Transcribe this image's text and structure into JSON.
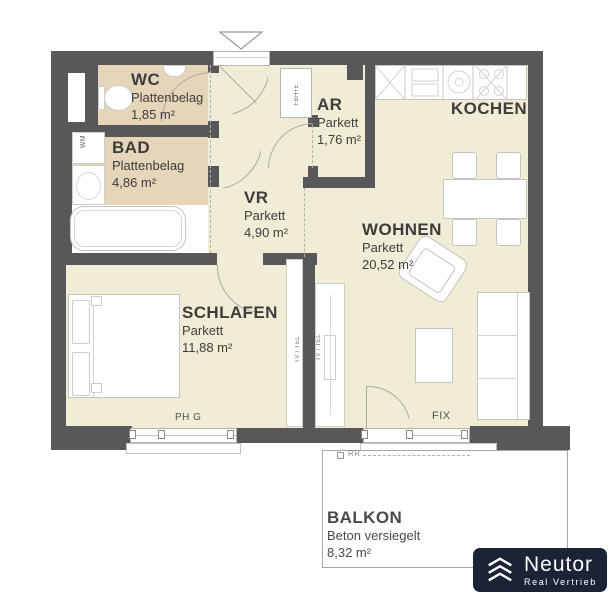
{
  "plan": {
    "rooms": {
      "wc": {
        "name": "WC",
        "floor": "Plattenbelag",
        "area": "1,85 m²"
      },
      "bad": {
        "name": "BAD",
        "floor": "Plattenbelag",
        "area": "4,86 m²"
      },
      "ar": {
        "name": "AR",
        "floor": "Parkett",
        "area": "1,76 m²"
      },
      "vr": {
        "name": "VR",
        "floor": "Parkett",
        "area": "4,90 m²"
      },
      "kochen": {
        "name": "KOCHEN"
      },
      "wohnen": {
        "name": "WOHNEN",
        "floor": "Parkett",
        "area": "20,52 m²"
      },
      "schlafen": {
        "name": "SCHLAFEN",
        "floor": "Parkett",
        "area": "11,88 m²"
      },
      "balkon": {
        "name": "BALKON",
        "floor": "Beton versiegelt",
        "area": "8,32 m²"
      }
    },
    "annotations": {
      "wm": "WM",
      "fbhe": "FBH+E",
      "tv_tel": "TV / TEL",
      "ph_g": "PH G",
      "fix": "FIX",
      "rr": "RR"
    },
    "colors": {
      "wall": "#58585a",
      "parkett": "#f1ecd6",
      "plattenbelag": "#e5d5b9",
      "logo_bg": "#1b2336"
    }
  },
  "logo": {
    "brand": "Neutor",
    "tagline": "Real Vertrieb"
  }
}
